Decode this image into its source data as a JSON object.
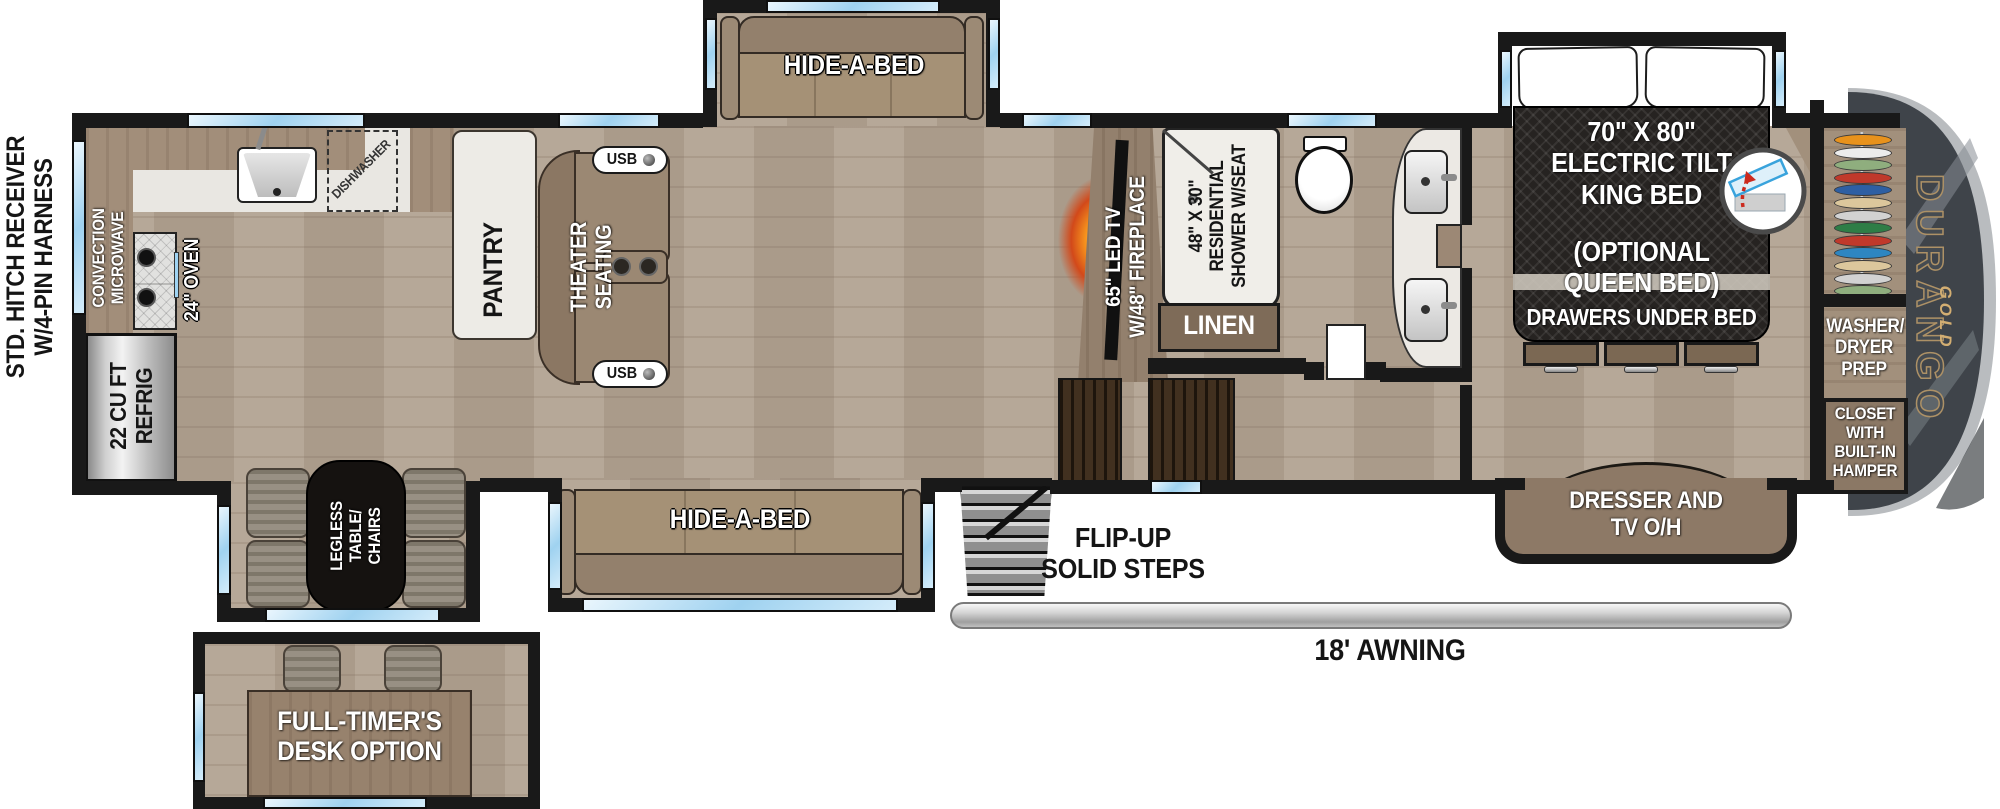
{
  "exterior": {
    "hitch": [
      "STD. HITCH RECEIVER",
      "W/4-PIN HARNESS"
    ],
    "awning": "18' AWNING",
    "steps": [
      "FLIP-UP",
      "SOLID STEPS"
    ],
    "brand": "DURANGO",
    "brand_sub": "GOLD"
  },
  "kitchen": {
    "convection": [
      "CONVECTION",
      "MICROWAVE"
    ],
    "oven": "24\" OVEN",
    "dishwasher": "DISHWASHER",
    "refrig": [
      "22 CU FT",
      "REFRIG"
    ],
    "pantry": "PANTRY"
  },
  "living": {
    "theater": [
      "THEATER",
      "SEATING"
    ],
    "usb": "USB",
    "hide_a_bed_top": "HIDE-A-BED",
    "hide_a_bed_bottom": "HIDE-A-BED",
    "tv": [
      "65\" LED TV",
      "W/48\" FIREPLACE"
    ]
  },
  "dinette": {
    "table": [
      "LEGLESS",
      "TABLE/",
      "CHAIRS"
    ],
    "desk": [
      "FULL-TIMER'S",
      "DESK OPTION"
    ]
  },
  "bath": {
    "shower": [
      "48\" X 30\"",
      "RESIDENTIAL",
      "SHOWER W/SEAT"
    ],
    "linen": "LINEN"
  },
  "bedroom": {
    "bed": [
      "70\" X 80\"",
      "ELECTRIC TILT",
      "KING BED"
    ],
    "bed_option": [
      "(OPTIONAL",
      "QUEEN BED)"
    ],
    "drawers": "DRAWERS UNDER BED",
    "dresser": [
      "DRESSER AND",
      "TV O/H"
    ],
    "washer": [
      "WASHER/",
      "DRYER",
      "PREP"
    ],
    "closet": [
      "CLOSET",
      "WITH",
      "BUILT-IN",
      "HAMPER"
    ]
  },
  "closet_hangers": [
    "#e8921c",
    "#ececec",
    "#8fae7e",
    "#c0392b",
    "#2e5fa3",
    "#dcc79c",
    "#d2d2d2",
    "#2e7d46",
    "#c0392b",
    "#2e86c1",
    "#dcc79c",
    "#d2d2d2",
    "#8fae7e"
  ],
  "colors": {
    "wall": "#191919",
    "window": "#9fd2f0",
    "floor": "#b2a392",
    "counter": "#a28e7a",
    "cabinet": "#8d7966",
    "sofa": "#a59176",
    "bed": "#262321",
    "fireplace": "#f7941d",
    "front_cap": "#3f444a",
    "cap_rim": "#b9bcbf"
  }
}
